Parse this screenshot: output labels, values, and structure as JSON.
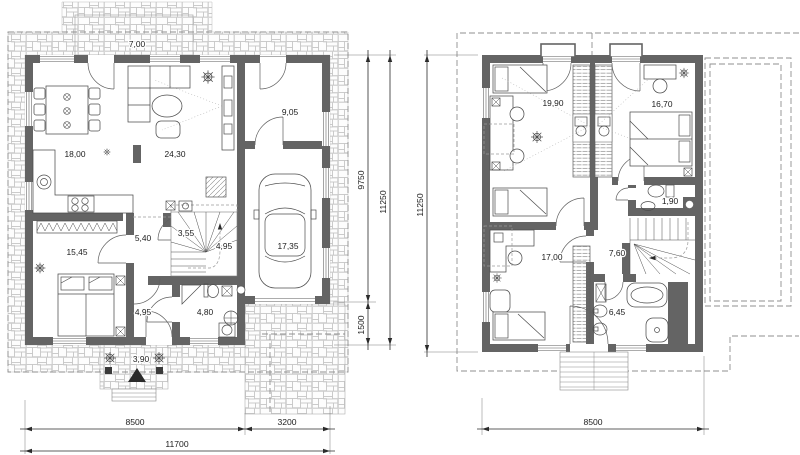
{
  "drawing": {
    "floor1": {
      "areas": {
        "terrace": "7,00",
        "dining_kitchen": "18,00",
        "living_room": "24,30",
        "utility_room": "9,05",
        "garage": "17,35",
        "bedroom": "15,45",
        "hall": "5,40",
        "closet": "3,55",
        "staircase": "4,95",
        "hall_lower": "4,95",
        "bathroom": "4,80",
        "porch": "3,90"
      },
      "dimensions": {
        "side_main": "9750",
        "side_total": "11250",
        "side_garage": "1500",
        "bottom_main": "8500",
        "bottom_garage": "3200",
        "bottom_total": "11700"
      }
    },
    "floor2": {
      "areas": {
        "bedroom_left": "19,90",
        "bedroom_right": "16,70",
        "wc": "1,90",
        "bedroom_lower": "17,00",
        "hall": "7,60",
        "bathroom": "6,45"
      },
      "dimensions": {
        "side_total": "11250",
        "bottom_main": "8500"
      }
    },
    "colors": {
      "wall": "#646464",
      "stone_joint": "#c2c2c2",
      "dash": "#8f8f8f",
      "text": "#1c1c1c"
    }
  }
}
